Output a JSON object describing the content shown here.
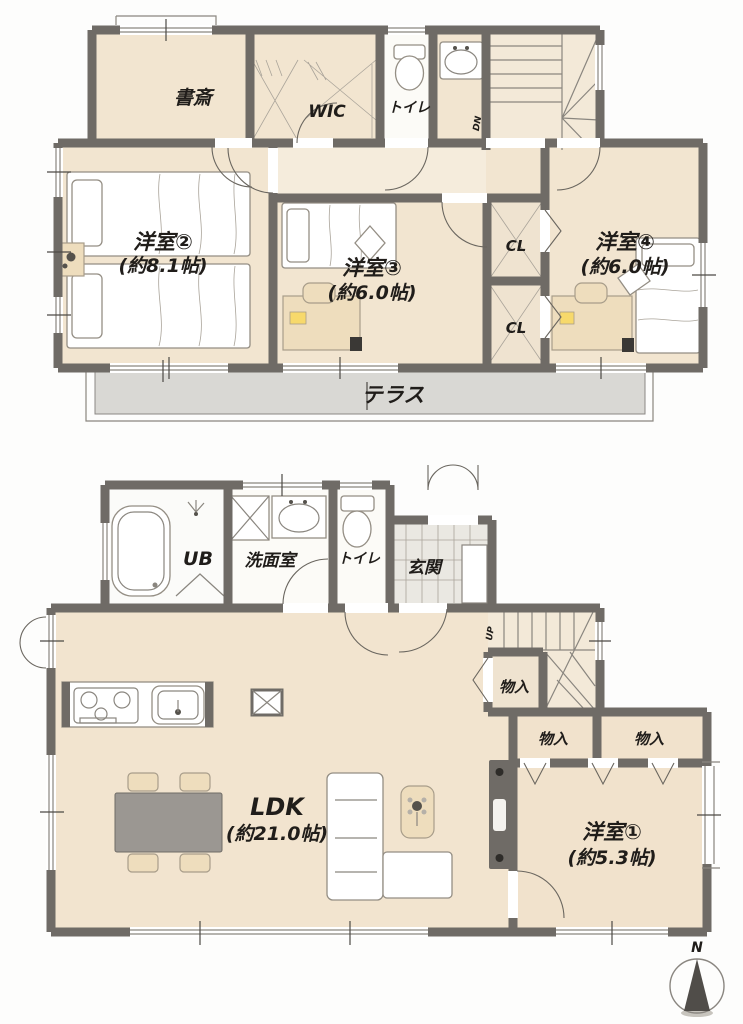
{
  "floor2": {
    "study": "書斎",
    "wic": "WIC",
    "toilet": "トイレ",
    "stairs": "DN",
    "bedroom2": {
      "name": "洋室②",
      "size": "(約8.1帖)"
    },
    "bedroom3": {
      "name": "洋室③",
      "size": "(約6.0帖)"
    },
    "bedroom4": {
      "name": "洋室④",
      "size": "(約6.0帖)"
    },
    "closet_upper": "CL",
    "closet_lower": "CL",
    "terrace": "テラス"
  },
  "floor1": {
    "bath": "UB",
    "washroom": "洗面室",
    "toilet": "トイレ",
    "entrance": "玄関",
    "stairs": "UP",
    "storage_hall": "物入",
    "storage_left": "物入",
    "storage_right": "物入",
    "ldk": {
      "name": "LDK",
      "size": "(約21.0帖)"
    },
    "bedroom1": {
      "name": "洋室①",
      "size": "(約5.3帖)"
    }
  },
  "compass": {
    "north": "N"
  },
  "colors": {
    "wall": "#6f6b66",
    "floor": "#f2e5d0",
    "hallway": "#f5ecdc",
    "wet_room": "#fcfbf7",
    "entrance_tile": "#eae8e2",
    "terrace": "#d9d8d4",
    "text": "#201d1a"
  }
}
